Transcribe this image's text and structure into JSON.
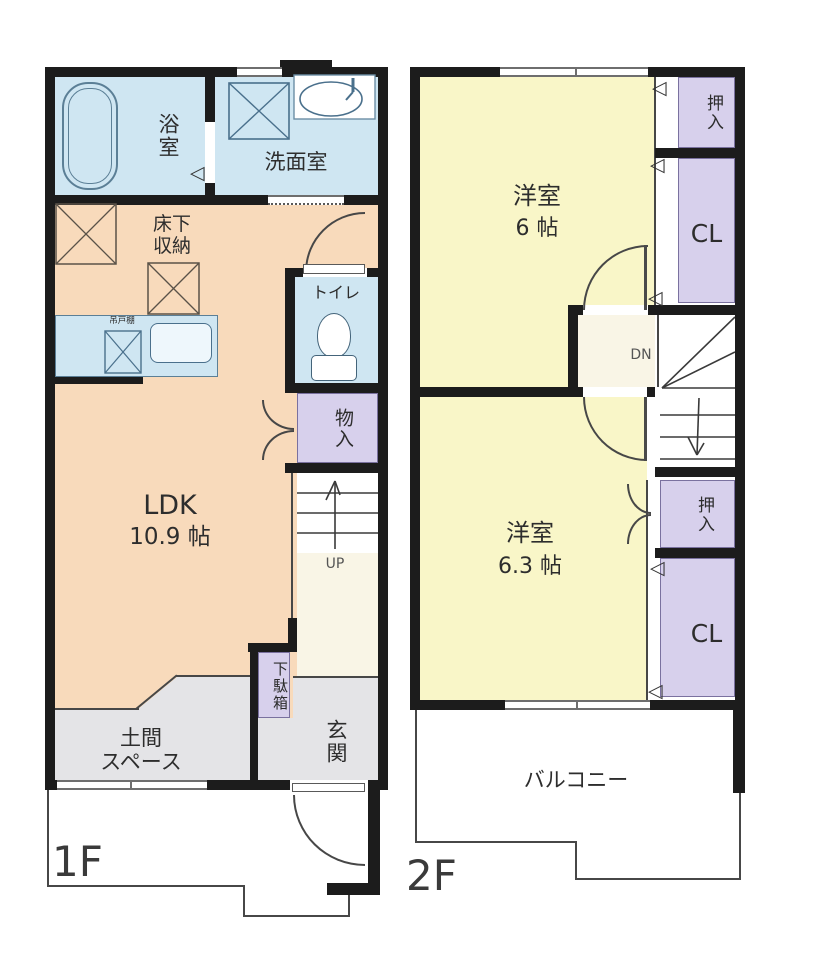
{
  "colors": {
    "wall": "#1c1c1c",
    "water": "#cfe6f2",
    "ldk": "#f8dabb",
    "bedroom": "#f9f6c8",
    "closet": "#d7d0ec",
    "ground": "#e4e4e7",
    "hall": "#f9f5e6",
    "line": "#474747",
    "text": "#2d2d2d",
    "fix": "#5b7f96"
  },
  "floor1": {
    "floor_label": "1F",
    "bath": "浴室",
    "washroom": "洗面室",
    "underfloor_storage": [
      "床下",
      "収納"
    ],
    "hanging_cupboard": "吊戸棚",
    "toilet": "トイレ",
    "storage": "物入",
    "ldk_name": "LDK",
    "ldk_size": "10.9 帖",
    "stairs_direction": "UP",
    "shoe_cabinet": "下駄箱",
    "entrance": "玄関",
    "doma": [
      "土間",
      "スペース"
    ]
  },
  "floor2": {
    "floor_label": "2F",
    "bedroom1_name": "洋室",
    "bedroom1_size": "6 帖",
    "closet1_upper": "押入",
    "closet1_lower": "CL",
    "stairs_direction": "DN",
    "bedroom2_name": "洋室",
    "bedroom2_size": "6.3 帖",
    "closet2_upper": "押入",
    "closet2_lower": "CL",
    "balcony": "バルコニー"
  },
  "icons": {
    "folding_door": "◁"
  }
}
